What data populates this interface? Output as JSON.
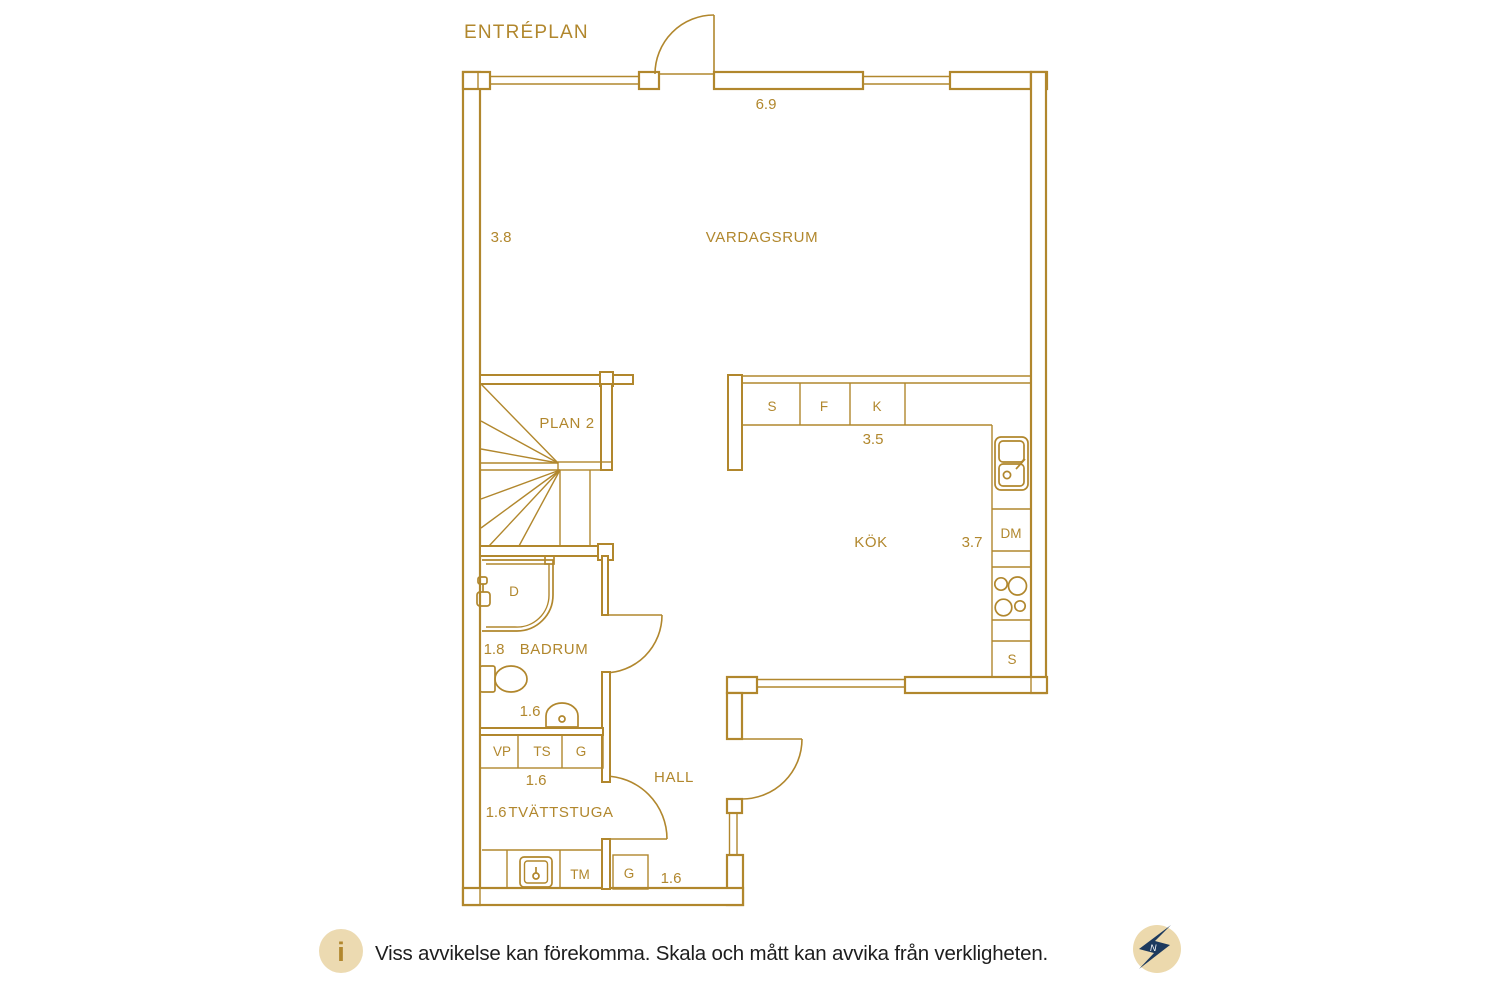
{
  "title": "ENTRÉPLAN",
  "labels": {
    "vardagsrum": "VARDAGSRUM",
    "kok": "KÖK",
    "badrum": "BADRUM",
    "hall": "HALL",
    "tvattstuga": "TVÄTTSTUGA",
    "plan2": "PLAN 2",
    "cabinet_s": "S",
    "cabinet_f": "F",
    "cabinet_k": "K",
    "dishwasher": "DM",
    "kitchen_closet": "S",
    "shower": "D",
    "vp": "VP",
    "ts": "TS",
    "closet_g1": "G",
    "washer_tm": "TM",
    "closet_g2": "G"
  },
  "dimensions": {
    "top_width": "6.9",
    "left_height": "3.8",
    "kitchen_width": "3.5",
    "kitchen_depth": "3.7",
    "badrum_width": "1.8",
    "badrum_depth": "1.6",
    "closet_row": "1.6",
    "tvattstuga_width": "1.6",
    "hall_bottom": "1.6"
  },
  "footer": {
    "info_symbol": "i",
    "disclaimer": "Viss avvikelse kan förekomma. Skala och mått kan avvika från verkligheten.",
    "compass_letter": "N"
  },
  "colors": {
    "plan_gold": "#b1872d",
    "footer_text": "#1e1e1e",
    "badge_tan": "#ecdab1",
    "compass_navy": "#1d3a5e"
  }
}
